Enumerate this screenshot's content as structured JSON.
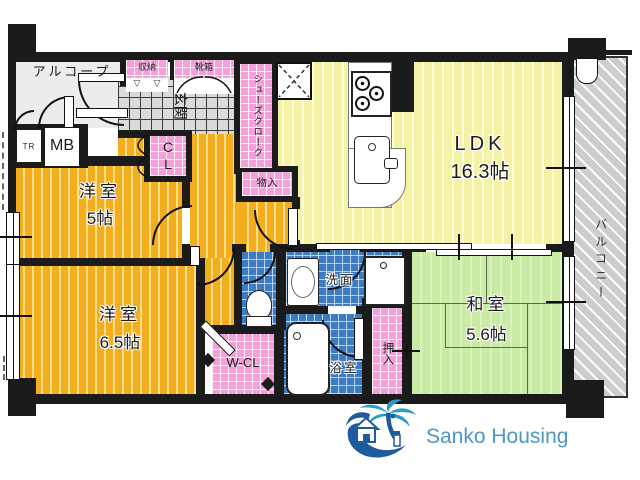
{
  "floorplan": {
    "alcove": "アルコープ",
    "storage_top": "収納",
    "shoe_box": "靴箱",
    "entrance": "玄関",
    "shoes_cloak": "シューズクローク",
    "trunk_room": "TR",
    "meter_box": "MB",
    "closet": "CL",
    "storage_small": "物入",
    "western_room_1": {
      "name": "洋室",
      "size": "5帖"
    },
    "western_room_2": {
      "name": "洋室",
      "size": "6.5帖"
    },
    "ldk": {
      "name": "LDK",
      "size": "16.3帖"
    },
    "washroom": "洗面",
    "bathroom": "浴室",
    "oshiire": "押入",
    "walk_in_closet": "W-CL",
    "japanese_room": {
      "name": "和室",
      "size": "5.6帖"
    },
    "balcony": "バルコニー"
  },
  "icons": {
    "folding_door": "▽"
  },
  "logo": {
    "brand": "Sanko Housing"
  },
  "colors": {
    "wall": "#1B1B1B",
    "western_room": "#F4AD1C",
    "ldk": "#F6F2A3",
    "japanese_room": "#C9EBA6",
    "closet_pink": "#F2A2D8",
    "wet_area_blue": "#3B7CC3",
    "entrance_tile": "#DADADA",
    "balcony": "#CDCDCD",
    "logo_blue": "#1E5C9C",
    "logo_text": "#4E96C6"
  }
}
